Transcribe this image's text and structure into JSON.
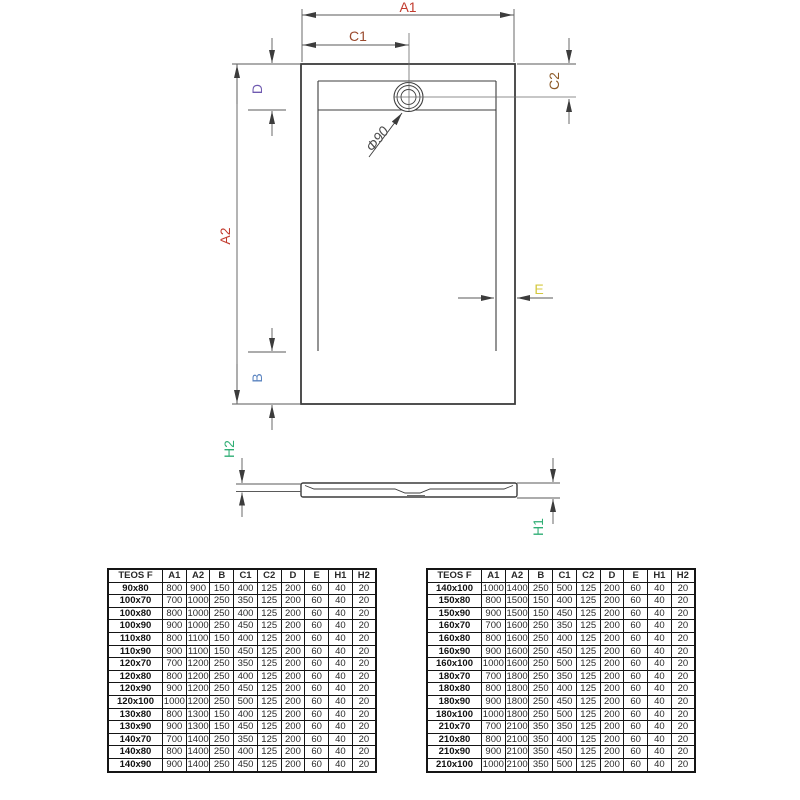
{
  "drawing": {
    "labels": {
      "a1": "A1",
      "a2": "A2",
      "b": "B",
      "c1": "C1",
      "c2": "C2",
      "d": "D",
      "e": "E",
      "h1": "H1",
      "h2": "H2",
      "drain_diameter": "Φ90"
    },
    "colors": {
      "a_dims": "#c23b2e",
      "b_dim": "#5b84c0",
      "c1_dim": "#9a4a2e",
      "c2_dim": "#8c5a28",
      "d_dim": "#6f5ab0",
      "e_dim": "#d4c83e",
      "h_dims": "#2fae74",
      "line": "#3c3c3c"
    }
  },
  "tables": {
    "left": {
      "headers": [
        {
          "label": "TEOS F",
          "color": "k"
        },
        {
          "label": "A1",
          "color": "red"
        },
        {
          "label": "A2",
          "color": "red"
        },
        {
          "label": "B",
          "color": "blue"
        },
        {
          "label": "C1",
          "color": "rust"
        },
        {
          "label": "C2",
          "color": "brown"
        },
        {
          "label": "D",
          "color": "purple"
        },
        {
          "label": "E",
          "color": "yellow"
        },
        {
          "label": "H1",
          "color": "green"
        },
        {
          "label": "H2",
          "color": "green"
        }
      ],
      "rows": [
        {
          "size": "90x80",
          "values": [
            800,
            900,
            150,
            400,
            125,
            200,
            60,
            40,
            20
          ]
        },
        {
          "size": "100x70",
          "values": [
            700,
            1000,
            250,
            350,
            125,
            200,
            60,
            40,
            20
          ]
        },
        {
          "size": "100x80",
          "values": [
            800,
            1000,
            250,
            400,
            125,
            200,
            60,
            40,
            20
          ]
        },
        {
          "size": "100x90",
          "values": [
            900,
            1000,
            250,
            450,
            125,
            200,
            60,
            40,
            20
          ]
        },
        {
          "size": "110x80",
          "values": [
            800,
            1100,
            150,
            400,
            125,
            200,
            60,
            40,
            20
          ]
        },
        {
          "size": "110x90",
          "values": [
            900,
            1100,
            150,
            450,
            125,
            200,
            60,
            40,
            20
          ]
        },
        {
          "size": "120x70",
          "values": [
            700,
            1200,
            250,
            350,
            125,
            200,
            60,
            40,
            20
          ]
        },
        {
          "size": "120x80",
          "values": [
            800,
            1200,
            250,
            400,
            125,
            200,
            60,
            40,
            20
          ]
        },
        {
          "size": "120x90",
          "values": [
            900,
            1200,
            250,
            450,
            125,
            200,
            60,
            40,
            20
          ]
        },
        {
          "size": "120x100",
          "values": [
            1000,
            1200,
            250,
            500,
            125,
            200,
            60,
            40,
            20
          ]
        },
        {
          "size": "130x80",
          "values": [
            800,
            1300,
            150,
            400,
            125,
            200,
            60,
            40,
            20
          ]
        },
        {
          "size": "130x90",
          "values": [
            900,
            1300,
            150,
            450,
            125,
            200,
            60,
            40,
            20
          ]
        },
        {
          "size": "140x70",
          "values": [
            700,
            1400,
            250,
            350,
            125,
            200,
            60,
            40,
            20
          ]
        },
        {
          "size": "140x80",
          "values": [
            800,
            1400,
            250,
            400,
            125,
            200,
            60,
            40,
            20
          ]
        },
        {
          "size": "140x90",
          "values": [
            900,
            1400,
            250,
            450,
            125,
            200,
            60,
            40,
            20
          ]
        }
      ]
    },
    "right": {
      "headers": [
        {
          "label": "TEOS F",
          "color": "k"
        },
        {
          "label": "A1",
          "color": "red"
        },
        {
          "label": "A2",
          "color": "red"
        },
        {
          "label": "B",
          "color": "blue"
        },
        {
          "label": "C1",
          "color": "rust"
        },
        {
          "label": "C2",
          "color": "brown"
        },
        {
          "label": "D",
          "color": "purple"
        },
        {
          "label": "E",
          "color": "yellow"
        },
        {
          "label": "H1",
          "color": "green"
        },
        {
          "label": "H2",
          "color": "green"
        }
      ],
      "rows": [
        {
          "size": "140x100",
          "values": [
            1000,
            1400,
            250,
            500,
            125,
            200,
            60,
            40,
            20
          ]
        },
        {
          "size": "150x80",
          "values": [
            800,
            1500,
            150,
            400,
            125,
            200,
            60,
            40,
            20
          ]
        },
        {
          "size": "150x90",
          "values": [
            900,
            1500,
            150,
            450,
            125,
            200,
            60,
            40,
            20
          ]
        },
        {
          "size": "160x70",
          "values": [
            700,
            1600,
            250,
            350,
            125,
            200,
            60,
            40,
            20
          ]
        },
        {
          "size": "160x80",
          "values": [
            800,
            1600,
            250,
            400,
            125,
            200,
            60,
            40,
            20
          ]
        },
        {
          "size": "160x90",
          "values": [
            900,
            1600,
            250,
            450,
            125,
            200,
            60,
            40,
            20
          ]
        },
        {
          "size": "160x100",
          "values": [
            1000,
            1600,
            250,
            500,
            125,
            200,
            60,
            40,
            20
          ]
        },
        {
          "size": "180x70",
          "values": [
            700,
            1800,
            250,
            350,
            125,
            200,
            60,
            40,
            20
          ]
        },
        {
          "size": "180x80",
          "values": [
            800,
            1800,
            250,
            400,
            125,
            200,
            60,
            40,
            20
          ]
        },
        {
          "size": "180x90",
          "values": [
            900,
            1800,
            250,
            450,
            125,
            200,
            60,
            40,
            20
          ]
        },
        {
          "size": "180x100",
          "values": [
            1000,
            1800,
            250,
            500,
            125,
            200,
            60,
            40,
            20
          ]
        },
        {
          "size": "210x70",
          "values": [
            700,
            2100,
            350,
            350,
            125,
            200,
            60,
            40,
            20
          ]
        },
        {
          "size": "210x80",
          "values": [
            800,
            2100,
            350,
            400,
            125,
            200,
            60,
            40,
            20
          ]
        },
        {
          "size": "210x90",
          "values": [
            900,
            2100,
            350,
            450,
            125,
            200,
            60,
            40,
            20
          ]
        },
        {
          "size": "210x100",
          "values": [
            1000,
            2100,
            350,
            500,
            125,
            200,
            60,
            40,
            20
          ]
        }
      ]
    }
  }
}
